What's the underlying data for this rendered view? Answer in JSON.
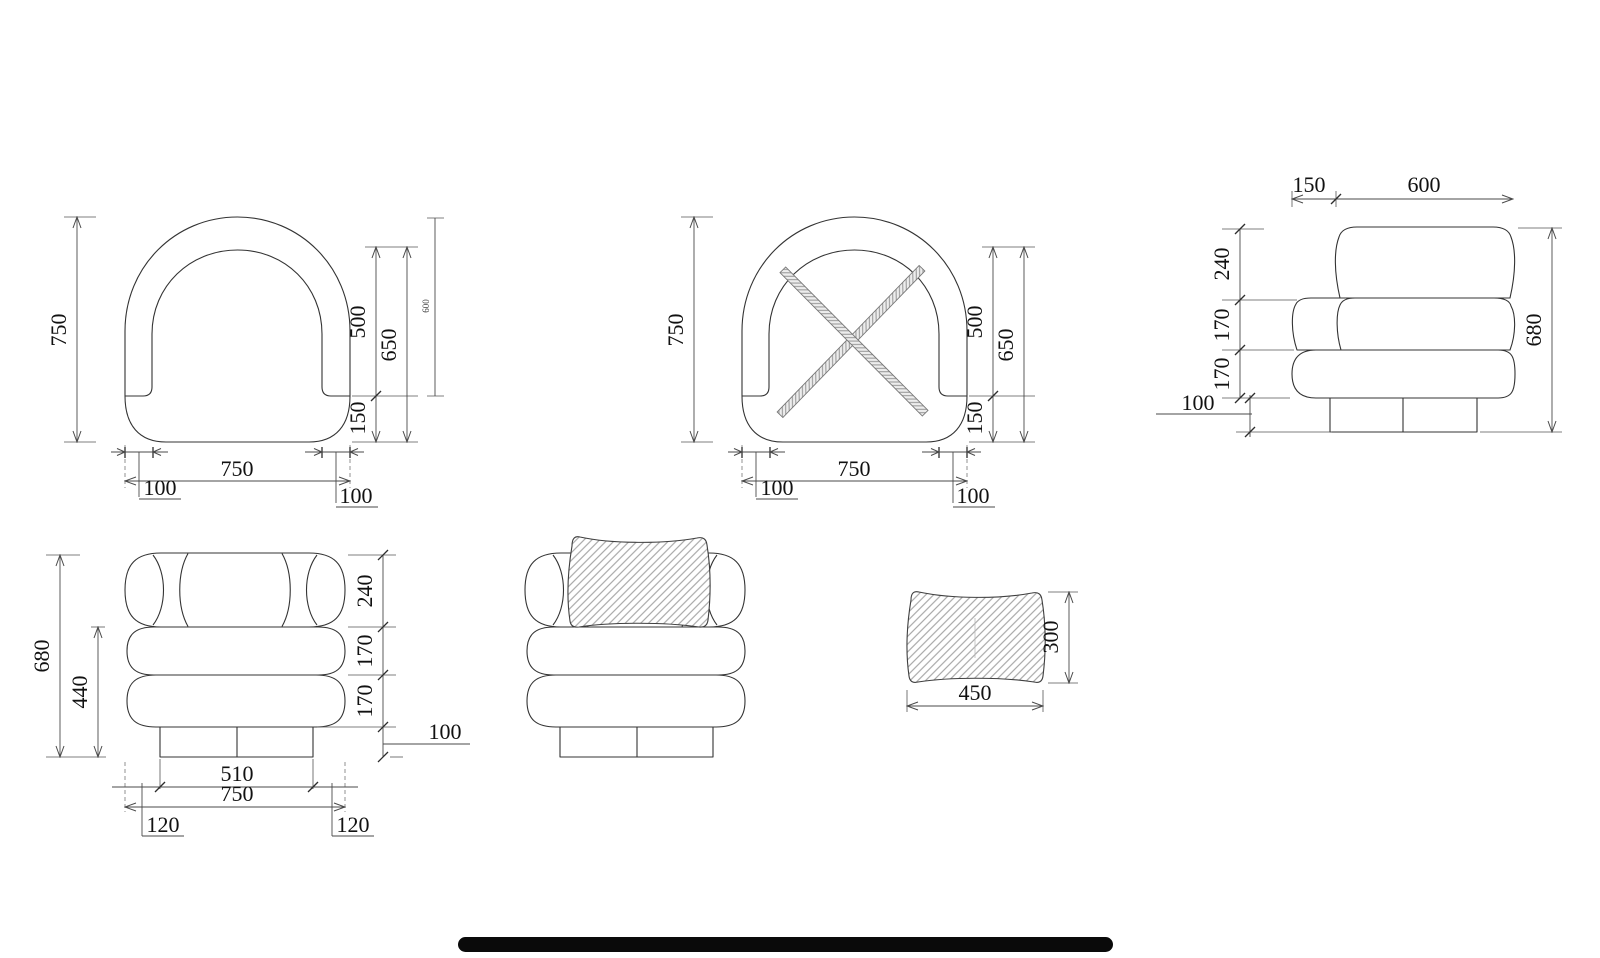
{
  "page": {
    "background": "#ffffff",
    "accent_bar_color": "#0a0a0a"
  },
  "drawing": {
    "line_color": "#333333",
    "dim_color": "#4a4a4a",
    "hatch_color": "#999999",
    "views": {
      "plan": {
        "dims": {
          "depth": "750",
          "seat_depth": "500",
          "seat_depth_total": "650",
          "front_band": "150",
          "width": "750",
          "arm_left": "100",
          "arm_right": "100",
          "depth_to_seat": "600"
        }
      },
      "plan_braced": {
        "dims": {
          "depth": "750",
          "seat_depth": "500",
          "seat_depth_total": "650",
          "front_band": "150",
          "width": "750",
          "arm_left": "100",
          "arm_right": "100"
        }
      },
      "side": {
        "dims": {
          "arm_front": "150",
          "seat_depth": "600",
          "back_height": "240",
          "mid_height": "170",
          "base_height": "170",
          "plinth_height": "100",
          "total_height": "680"
        }
      },
      "front": {
        "dims": {
          "total_height": "680",
          "arm_height": "440",
          "back_height": "240",
          "mid_height": "170",
          "base_height": "170",
          "plinth_height": "100",
          "plinth_width": "510",
          "width": "750",
          "side_left": "120",
          "side_right": "120"
        }
      },
      "cushion": {
        "dims": {
          "width": "450",
          "height": "300"
        }
      }
    }
  }
}
